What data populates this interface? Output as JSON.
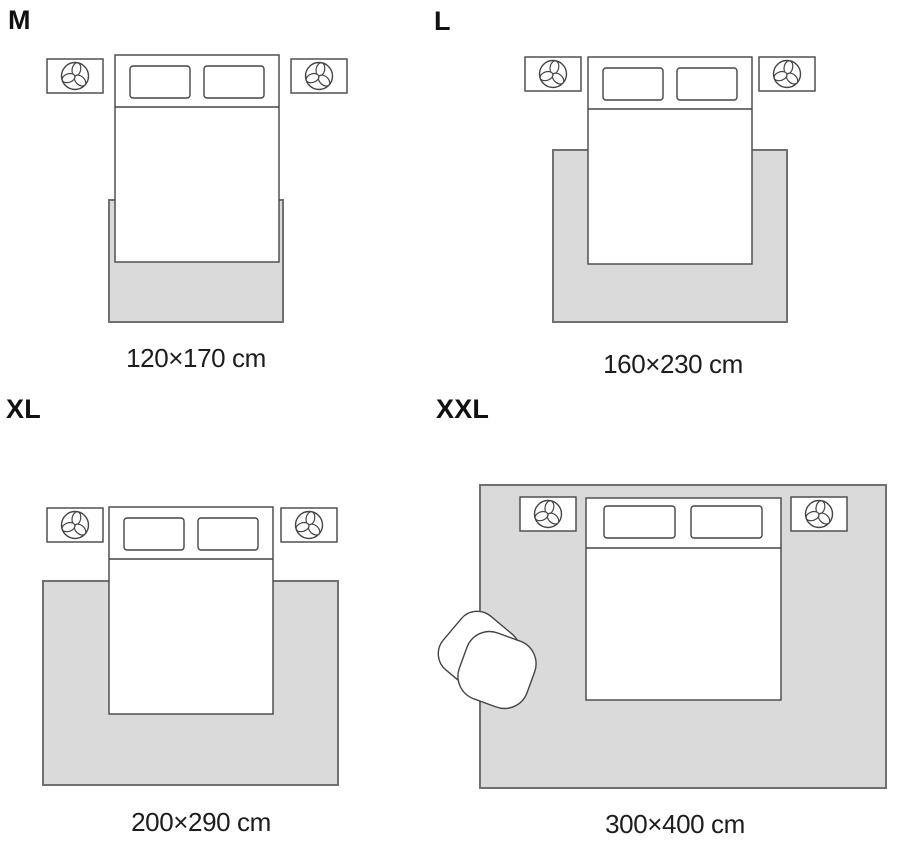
{
  "guide": {
    "type": "rug-size-guide",
    "sizes": [
      {
        "code": "M",
        "dimensions": "120×170 cm"
      },
      {
        "code": "L",
        "dimensions": "160×230 cm"
      },
      {
        "code": "XL",
        "dimensions": "200×290 cm"
      },
      {
        "code": "XXL",
        "dimensions": "300×400 cm"
      }
    ]
  },
  "icons": {
    "nightstand_decor": "plant-icon",
    "xxl_extra_furniture": "armchair"
  },
  "colors": {
    "background": "#ffffff",
    "rug_fill": "#dadada",
    "rug_border": "#707070",
    "furniture_line": "#454545",
    "label_text": "#111111",
    "caption_text": "#1d1d1f"
  }
}
